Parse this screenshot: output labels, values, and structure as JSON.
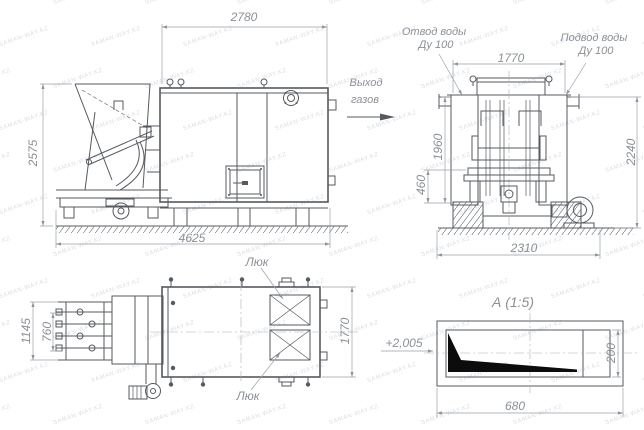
{
  "watermark": {
    "text": "SAMAN-WAY.KZ"
  },
  "colors": {
    "line": "#555a60",
    "dim": "#9aa0a7",
    "text": "#8b9097",
    "wm": "#bcc4d1",
    "black": "#0c0c0c"
  },
  "side_view": {
    "dim_body_width": "2780",
    "dim_height": "2575",
    "dim_overall_length": "4625"
  },
  "front_view": {
    "gas_exit": {
      "line1": "Выход",
      "line2": "газов"
    },
    "water_outlet": {
      "line1": "Отвод воды",
      "line2": "Ду 100"
    },
    "water_inlet": {
      "line1": "Подвод воды",
      "line2": "Ду 100"
    },
    "dim_width_top": "1770",
    "dim_body_height": "1960",
    "dim_base_height": "460",
    "dim_overall_height": "2240",
    "dim_foundation_width": "2310"
  },
  "plan_view": {
    "hatch_label_top": "Люк",
    "hatch_label_bottom": "Люк",
    "dim_feeder_width": "1145",
    "dim_feeder_inner_width": "760",
    "dim_depth": "1770"
  },
  "detail_view": {
    "title": "А (1:5)",
    "dim_ref_length": "+2,005",
    "dim_height": "200",
    "dim_width": "680"
  }
}
